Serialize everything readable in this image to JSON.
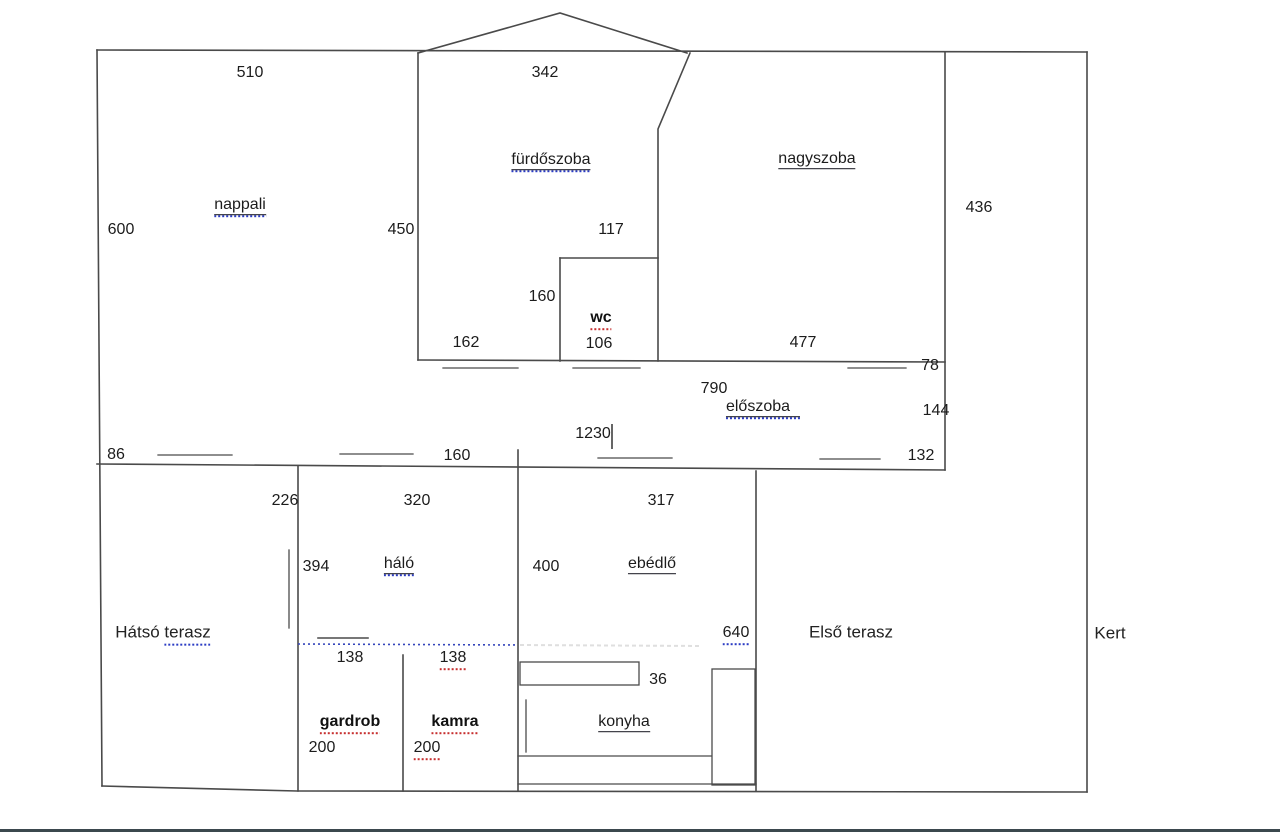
{
  "document_type": "floor-plan",
  "colors": {
    "wall": "#4a4a4a",
    "furniture": "#4a4a4a",
    "text": "#1c1c1c",
    "spellcheck_blue": "#2b3cc4",
    "spellcheck_red": "#c62f2f",
    "dotted_wall_blue": "#3344bb",
    "separator_bar": "#3b484e",
    "background": "#ffffff"
  },
  "rooms": {
    "nappali": "nappali",
    "furdoszoba": "fürdőszoba",
    "nagyszoba": "nagyszoba",
    "wc": "wc",
    "eloszoba": "előszoba",
    "halo": "háló",
    "ebedlo": "ebédlő",
    "gardrob": "gardrob",
    "kamra": "kamra",
    "konyha": "konyha"
  },
  "areas": {
    "hatso_prefix": "Hátsó",
    "hatso_word": "terasz",
    "elso_terasz": "Első terasz",
    "kert": "Kert"
  },
  "dimensions": {
    "nappali_top": "510",
    "furdoszoba_top": "342",
    "nappali_left": "600",
    "furdoszoba_left": "450",
    "wc_top": "117",
    "nagyszoba_right": "436",
    "wc_left": "160",
    "under_furdoszoba": "162",
    "wc_bottom": "106",
    "nagyszoba_bottom": "477",
    "eloszoba_right_top": "78",
    "eloszoba_width": "790",
    "eloszoba_right": "144",
    "house_width": "1230",
    "hatso_window": "86",
    "corridor_window": "160",
    "eloszoba_bottom_right": "132",
    "hatso_top": "226",
    "halo_top": "320",
    "ebedlo_top": "317",
    "halo_left": "394",
    "ebedlo_left": "400",
    "ebedlo_bottom": "640",
    "gardrob_top": "138",
    "kamra_top": "138",
    "counter_depth": "36",
    "gardrob_left": "200",
    "kamra_left": "200"
  }
}
